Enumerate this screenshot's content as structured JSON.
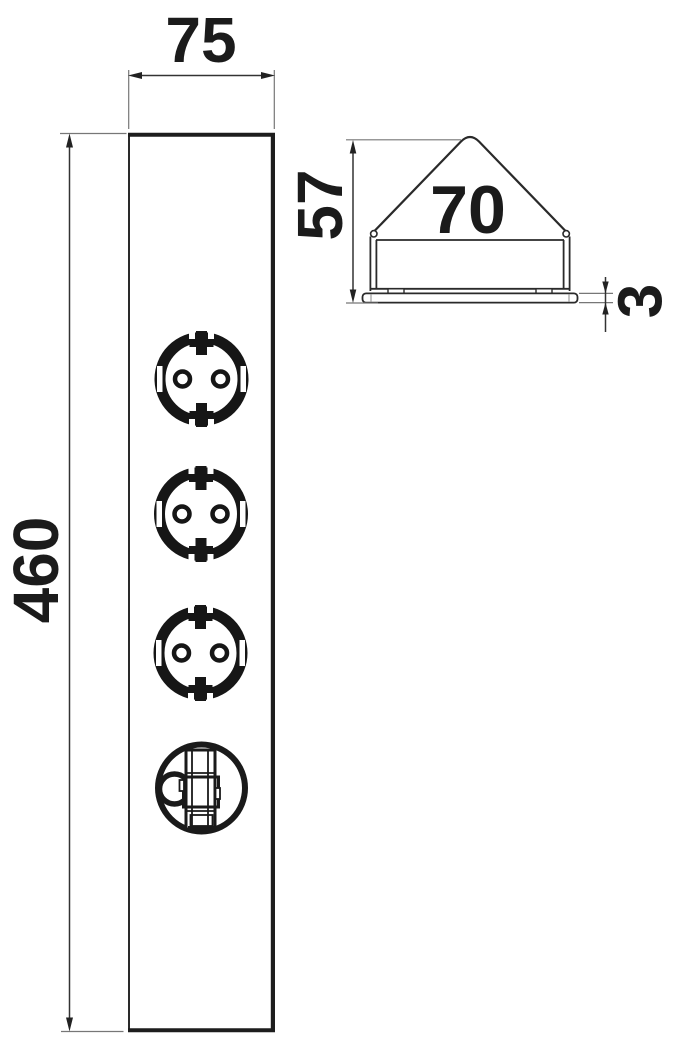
{
  "drawing": {
    "description": "technical dimension drawing of corner power strip with 3 Schuko sockets and pull-ring module",
    "front_view": {
      "width_mm": "75",
      "height_mm": "460"
    },
    "profile_view": {
      "height_mm": "57",
      "width_mm": "70",
      "plate_thickness_mm": "3"
    },
    "colors": {
      "line": "#222222",
      "thin_line": "#777777",
      "text": "#1b1b1b",
      "background": "#ffffff"
    }
  }
}
